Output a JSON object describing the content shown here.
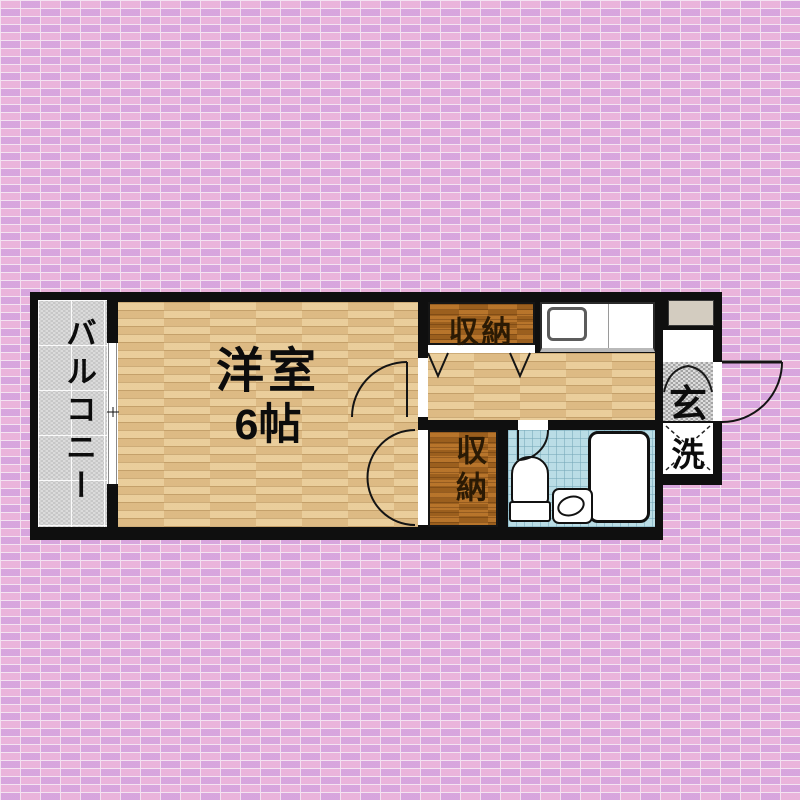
{
  "floorplan": {
    "balcony_label": "バルコニー",
    "room_name": "洋室",
    "room_size": "6帖",
    "closet_upper_label": "収納",
    "closet_lower_label": "収納",
    "entrance_label": "玄",
    "laundry_label": "洗",
    "colors": {
      "wall": "#0f0f0f",
      "brick": "#e9b3dc",
      "wood_floor": "#e7c795",
      "closet_wood": "#b06f27",
      "balcony_concrete": "#d6d6d6",
      "bathroom_tile": "#badde6",
      "shoe_cabinet": "#d3ccc0"
    },
    "icons": {
      "balcony_window": "sliding-window",
      "room_door": "inward-swing-door",
      "closet_lower_door": "double-swing-door",
      "closet_upper_door": "folding-doors",
      "bathroom_door": "inward-swing-door",
      "front_door": "outward-swing-door",
      "laundry_space": "dashed-cross-square",
      "kitchen_sink": "counter-sink",
      "toilet": "toilet",
      "wash_basin": "basin",
      "bathtub": "bathtub"
    }
  }
}
